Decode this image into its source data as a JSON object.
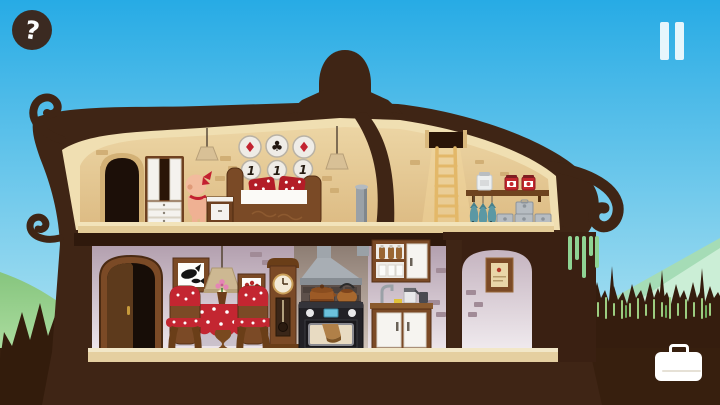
{
  "hud": {
    "help": {
      "icon": "question-mark-icon",
      "glyph": "?"
    },
    "pause": {
      "icon": "pause-icon"
    },
    "inventory": {
      "icon": "suitcase-icon"
    }
  },
  "house": {
    "upper_floor": {
      "bedroom": {
        "suit_plates": {
          "glyphs": [
            "♦",
            "♣",
            "♦"
          ],
          "colors": [
            "#c22330",
            "#221710",
            "#c22330"
          ]
        },
        "number_plates": {
          "values": [
            "1",
            "1",
            "1"
          ]
        },
        "items": [
          "arched-window",
          "wardrobe",
          "pendant-lamp",
          "pendant-lamp",
          "baby-character-with-red-bow",
          "nightstand",
          "bed-with-red-polka-pillows",
          "chimney-pipe"
        ]
      },
      "attic": {
        "items": [
          "roof-hatch",
          "ladder",
          "shelf",
          "white-jar",
          "red-jar",
          "red-jar",
          "hanging-fish",
          "hanging-fish",
          "hanging-fish",
          "metal-box",
          "metal-box",
          "metal-box",
          "metal-box"
        ]
      }
    },
    "lower_floor": {
      "dining_room": {
        "items": [
          "front-door",
          "whale-picture",
          "pendant-lamp",
          "flower-picture",
          "dining-table-red-polka-cloth",
          "flower-vase",
          "chair",
          "chair",
          "grandfather-clock"
        ]
      },
      "kitchen": {
        "items": [
          "range-hood",
          "stove-with-pots",
          "upper-cabinet-bottles-glasses",
          "faucet",
          "counter",
          "coffee-maker",
          "base-cabinet"
        ]
      },
      "alcove": {
        "items": [
          "framed-note"
        ]
      }
    }
  },
  "environment": {
    "items": [
      "sky",
      "green-hills",
      "pine-forest-silhouette",
      "bush-silhouette",
      "scarecrow-roof-topper",
      "roof-swirls",
      "hanging-vines"
    ]
  },
  "palette": {
    "sky_top": "#27abe5",
    "sky_bottom": "#c3ebf3",
    "hill_green": "#9ed4a0",
    "hill_mint": "#cbeed6",
    "silhouette_brown": "#351d0e",
    "house_brown": "#3f2515",
    "wall_upper_tan": "#e3c28c",
    "wall_lower_mauve": "#cbb9c6",
    "trim_cream": "#f0dfb2",
    "wood_brown": "#7b4a26",
    "accent_red": "#c32631",
    "fish_teal": "#5b98a4",
    "stove_black": "#222126",
    "ui_white": "#ffffff"
  }
}
